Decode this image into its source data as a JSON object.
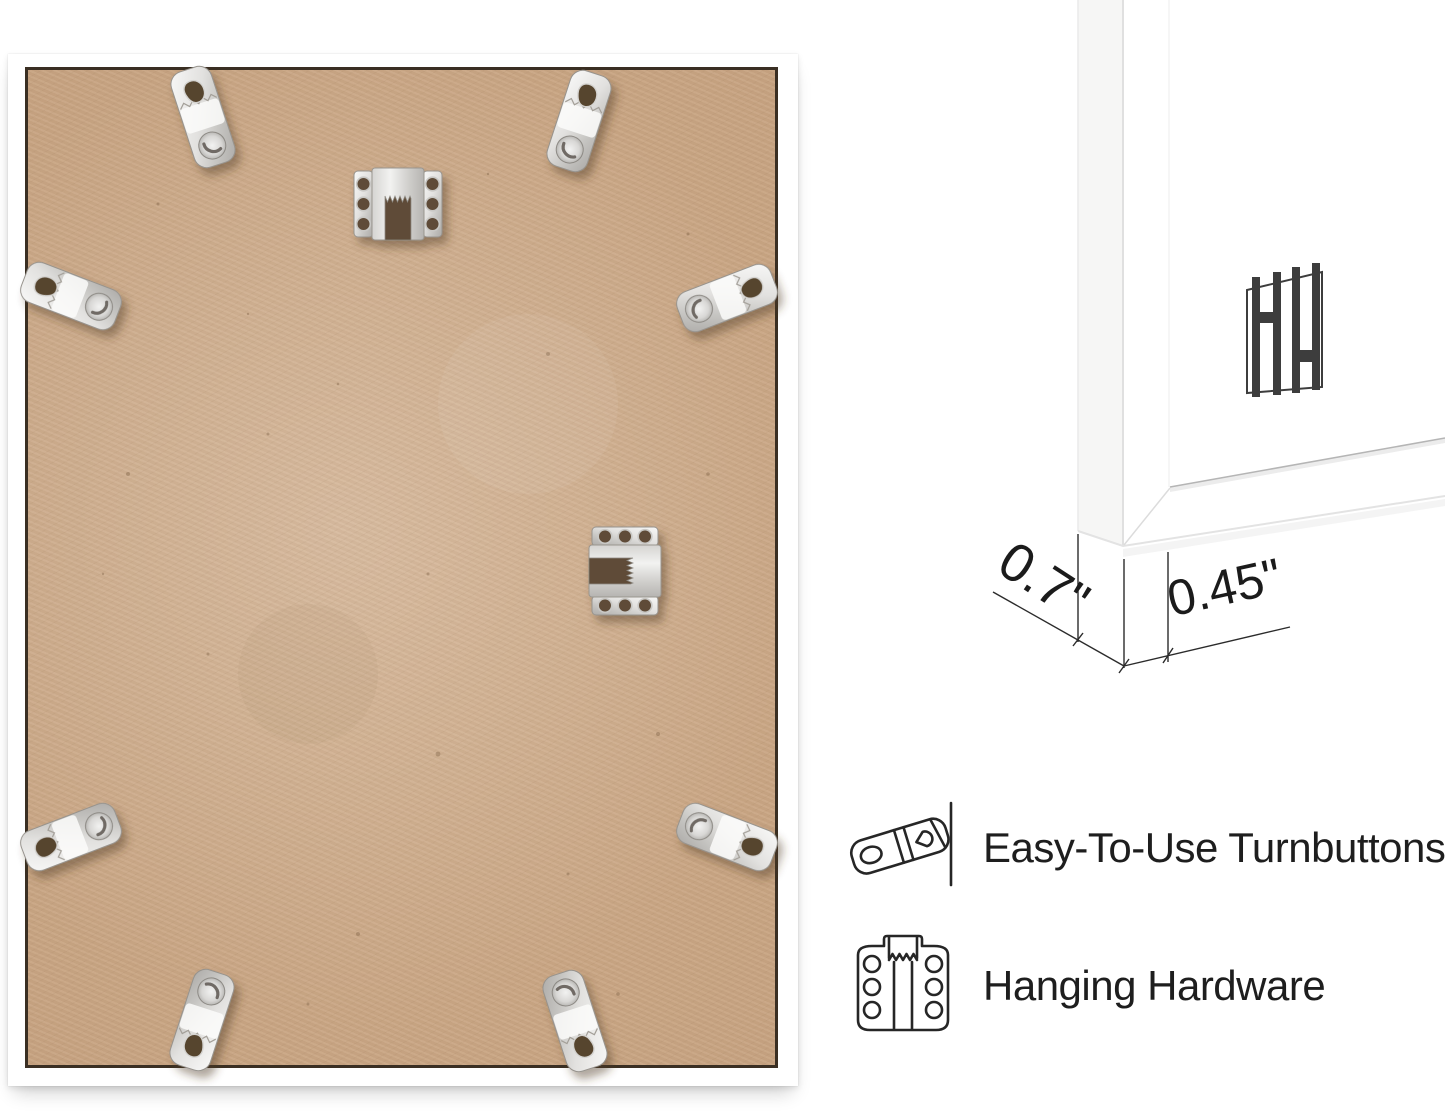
{
  "corner_view": {
    "measurements": {
      "depth": "0.7\"",
      "face": "0.45\""
    },
    "logo_monogram": "HH"
  },
  "features": [
    {
      "label": "Easy-To-Use Turnbuttons",
      "icon": "turnbutton-icon"
    },
    {
      "label": "Hanging Hardware",
      "icon": "hanging-hardware-icon"
    }
  ],
  "photo": {
    "hardware": {
      "turnbuttons": 8,
      "sawtooth_hangers": 2
    }
  },
  "colors": {
    "background": "#ffffff",
    "frame_white": "#ffffff",
    "mdf_tan": "#c7a381",
    "mdf_dark_edge": "#aa865f",
    "rabbet_line": "#3a2f23",
    "metal_silver": "#d9d8d6",
    "hole_shadow": "#5e4c38",
    "annotation_dark": "#1f1f1f",
    "logo_gray": "#3d3d3d"
  }
}
